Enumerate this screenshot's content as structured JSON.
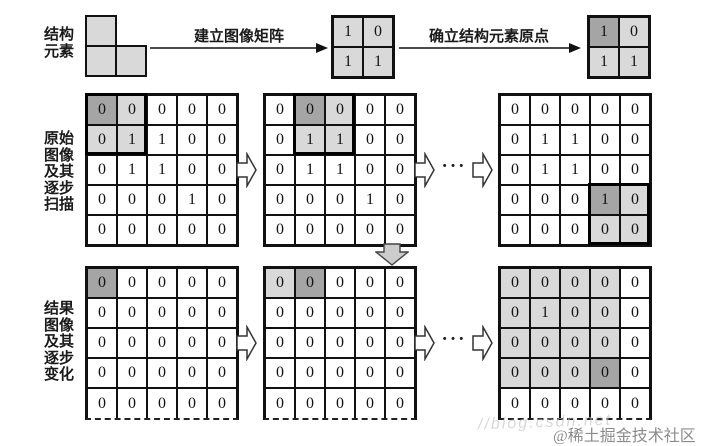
{
  "ellipsis": "···",
  "colors": {
    "cell_light": "#d9d9d9",
    "cell_dark": "#a5a5a5",
    "arrow_fill": "#cccccc",
    "line": "#111111"
  },
  "top": {
    "label": "结构\n元素",
    "arrow1_label": "建立图像矩阵",
    "arrow2_label": "确立结构元素原点",
    "se_matrix": {
      "values": [
        [
          "1",
          "0"
        ],
        [
          "1",
          "1"
        ]
      ],
      "shades": [
        [
          "l",
          "l"
        ],
        [
          "l",
          "l"
        ]
      ]
    },
    "se_origin_matrix": {
      "values": [
        [
          "1",
          "0"
        ],
        [
          "1",
          "1"
        ]
      ],
      "shades": [
        [
          "d",
          "l"
        ],
        [
          "l",
          "l"
        ]
      ]
    }
  },
  "middle": {
    "label": "原始\n图像\n及其\n逐步\n扫描",
    "m1": {
      "values": [
        [
          "0",
          "0",
          "0",
          "0",
          "0"
        ],
        [
          "0",
          "1",
          "1",
          "0",
          "0"
        ],
        [
          "0",
          "1",
          "1",
          "0",
          "0"
        ],
        [
          "0",
          "0",
          "0",
          "1",
          "0"
        ],
        [
          "0",
          "0",
          "0",
          "0",
          "0"
        ]
      ],
      "shades": [
        [
          "d",
          "l",
          "",
          "",
          ""
        ],
        [
          "l",
          "l",
          "",
          "",
          ""
        ],
        [
          "",
          "",
          "",
          "",
          ""
        ],
        [
          "",
          "",
          "",
          "",
          ""
        ],
        [
          "",
          "",
          "",
          "",
          ""
        ]
      ],
      "window": {
        "r": 0,
        "c": 0,
        "rows": 2,
        "cols": 2
      }
    },
    "m2": {
      "values": [
        [
          "0",
          "0",
          "0",
          "0",
          "0"
        ],
        [
          "0",
          "1",
          "1",
          "0",
          "0"
        ],
        [
          "0",
          "1",
          "1",
          "0",
          "0"
        ],
        [
          "0",
          "0",
          "0",
          "1",
          "0"
        ],
        [
          "0",
          "0",
          "0",
          "0",
          "0"
        ]
      ],
      "shades": [
        [
          "",
          "d",
          "l",
          "",
          ""
        ],
        [
          "",
          "l",
          "l",
          "",
          ""
        ],
        [
          "",
          "",
          "",
          "",
          ""
        ],
        [
          "",
          "",
          "",
          "",
          ""
        ],
        [
          "",
          "",
          "",
          "",
          ""
        ]
      ],
      "window": {
        "r": 0,
        "c": 1,
        "rows": 2,
        "cols": 2
      }
    },
    "m3": {
      "values": [
        [
          "0",
          "0",
          "0",
          "0",
          "0"
        ],
        [
          "0",
          "1",
          "1",
          "0",
          "0"
        ],
        [
          "0",
          "1",
          "1",
          "0",
          "0"
        ],
        [
          "0",
          "0",
          "0",
          "1",
          "0"
        ],
        [
          "0",
          "0",
          "0",
          "0",
          "0"
        ]
      ],
      "shades": [
        [
          "",
          "",
          "",
          "",
          ""
        ],
        [
          "",
          "",
          "",
          "",
          ""
        ],
        [
          "",
          "",
          "",
          "",
          ""
        ],
        [
          "",
          "",
          "",
          "d",
          "l"
        ],
        [
          "",
          "",
          "",
          "l",
          "l"
        ]
      ],
      "window": {
        "r": 3,
        "c": 3,
        "rows": 2,
        "cols": 2
      }
    }
  },
  "bottom": {
    "label": "结果\n图像\n及其\n逐步\n变化",
    "r1": {
      "values": [
        [
          "0",
          "0",
          "0",
          "0",
          "0"
        ],
        [
          "0",
          "0",
          "0",
          "0",
          "0"
        ],
        [
          "0",
          "0",
          "0",
          "0",
          "0"
        ],
        [
          "0",
          "0",
          "0",
          "0",
          "0"
        ],
        [
          "0",
          "0",
          "0",
          "0",
          "0"
        ]
      ],
      "shades": [
        [
          "d",
          "",
          "",
          "",
          ""
        ],
        [
          "",
          "",
          "",
          "",
          ""
        ],
        [
          "",
          "",
          "",
          "",
          ""
        ],
        [
          "",
          "",
          "",
          "",
          ""
        ],
        [
          "",
          "",
          "",
          "",
          ""
        ]
      ]
    },
    "r2": {
      "values": [
        [
          "0",
          "0",
          "0",
          "0",
          "0"
        ],
        [
          "0",
          "0",
          "0",
          "0",
          "0"
        ],
        [
          "0",
          "0",
          "0",
          "0",
          "0"
        ],
        [
          "0",
          "0",
          "0",
          "0",
          "0"
        ],
        [
          "0",
          "0",
          "0",
          "0",
          "0"
        ]
      ],
      "shades": [
        [
          "l",
          "d",
          "",
          "",
          ""
        ],
        [
          "",
          "",
          "",
          "",
          ""
        ],
        [
          "",
          "",
          "",
          "",
          ""
        ],
        [
          "",
          "",
          "",
          "",
          ""
        ],
        [
          "",
          "",
          "",
          "",
          ""
        ]
      ]
    },
    "r3": {
      "values": [
        [
          "0",
          "0",
          "0",
          "0",
          "0"
        ],
        [
          "0",
          "1",
          "0",
          "0",
          "0"
        ],
        [
          "0",
          "0",
          "0",
          "0",
          "0"
        ],
        [
          "0",
          "0",
          "0",
          "0",
          "0"
        ],
        [
          "0",
          "0",
          "0",
          "0",
          "0"
        ]
      ],
      "shades": [
        [
          "l",
          "l",
          "l",
          "l",
          ""
        ],
        [
          "l",
          "l",
          "l",
          "l",
          ""
        ],
        [
          "l",
          "l",
          "l",
          "l",
          ""
        ],
        [
          "l",
          "l",
          "l",
          "d",
          ""
        ],
        [
          "",
          "",
          "",
          "",
          ""
        ]
      ]
    }
  },
  "watermark": {
    "faded": "//blog.csdn.net",
    "community": "@稀土掘金技术社区"
  }
}
